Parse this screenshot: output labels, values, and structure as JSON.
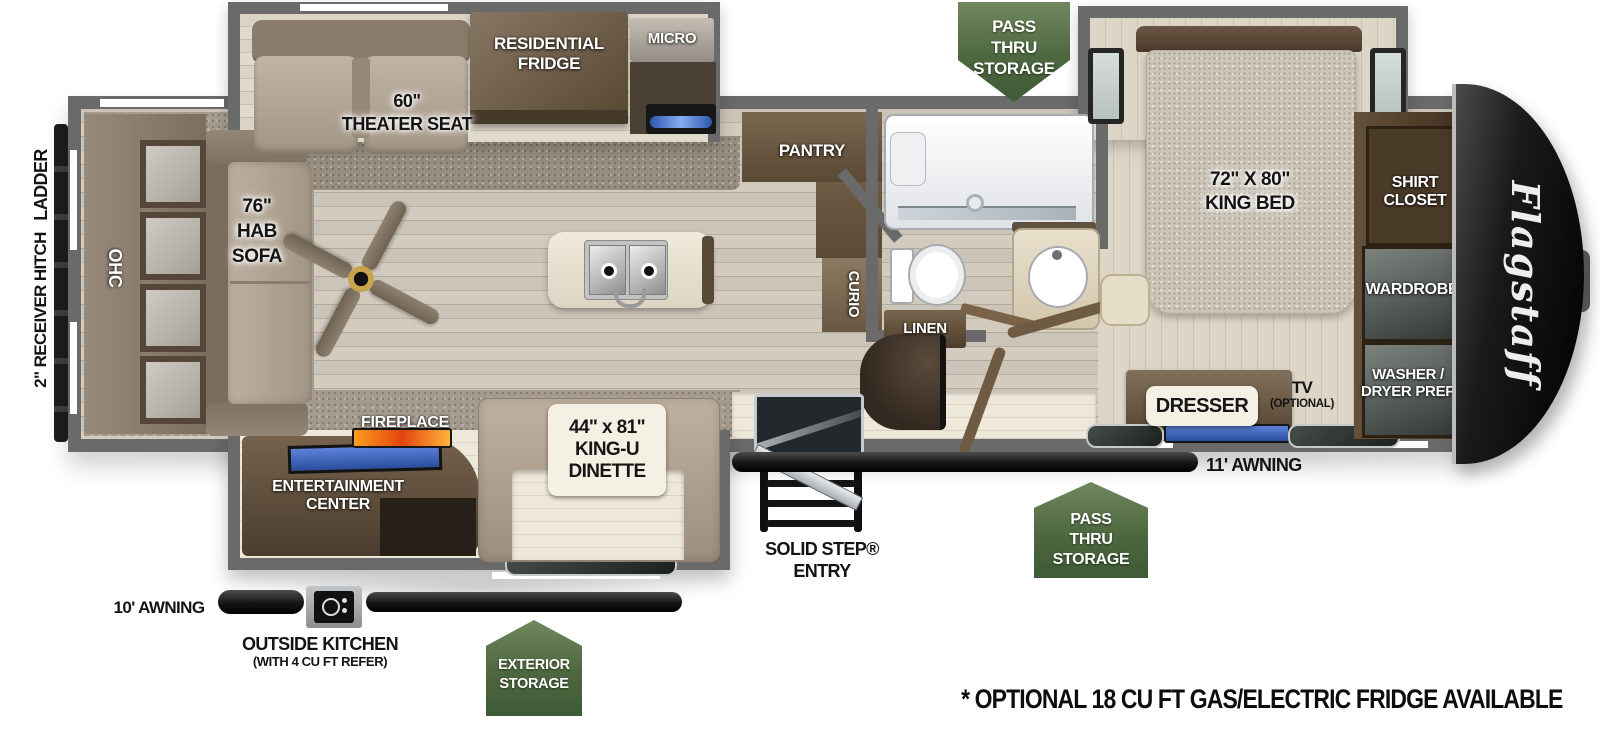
{
  "brand": "Flagstaff",
  "exterior": {
    "ladder": "LADDER",
    "receiver_hitch": "2\" RECEIVER HITCH",
    "awning_left": "10' AWNING",
    "awning_right": "11' AWNING",
    "outside_kitchen": [
      "OUTSIDE KITCHEN",
      "(WITH 4 CU FT REFER)"
    ],
    "entry": [
      "SOLID STEP®",
      "ENTRY"
    ],
    "note": "* OPTIONAL 18 CU FT GAS/ELECTRIC FRIDGE AVAILABLE"
  },
  "badges": {
    "pass_thru_top": [
      "PASS",
      "THRU",
      "STORAGE"
    ],
    "pass_thru_bottom": [
      "PASS",
      "THRU",
      "STORAGE"
    ],
    "exterior_storage": [
      "EXTERIOR",
      "STORAGE"
    ]
  },
  "living": {
    "ohc": "OHC",
    "sofa": [
      "76\"",
      "HAB",
      "SOFA"
    ],
    "theater_seat": [
      "60\"",
      "THEATER SEAT"
    ],
    "fridge": [
      "RESIDENTIAL",
      "FRIDGE"
    ],
    "micro": "MICRO",
    "fireplace": "FIREPLACE",
    "entertainment": [
      "ENTERTAINMENT",
      "CENTER"
    ],
    "dinette": [
      "44\" x 81\"",
      "KING-U",
      "DINETTE"
    ]
  },
  "kitchen": {
    "pantry": "PANTRY",
    "curio": "CURIO"
  },
  "bath": {
    "linen": "LINEN"
  },
  "bedroom": {
    "king_bed": [
      "72\" X 80\"",
      "KING BED"
    ],
    "dresser": "DRESSER",
    "tv": [
      "TV",
      "(OPTIONAL)"
    ],
    "shirt_closet": [
      "SHIRT",
      "CLOSET"
    ],
    "wardrobe": "WARDROBE",
    "washer_dryer": [
      "WASHER /",
      "DRYER PREP"
    ]
  },
  "colors": {
    "badge_green_dark": "#47613f",
    "badge_green_light": "#6b8261",
    "wall_gray": "#6a6a6a",
    "cap_black": "#0e0e0e",
    "fire_orange": "#ef7f18",
    "tv_blue": "#3c63b5"
  }
}
